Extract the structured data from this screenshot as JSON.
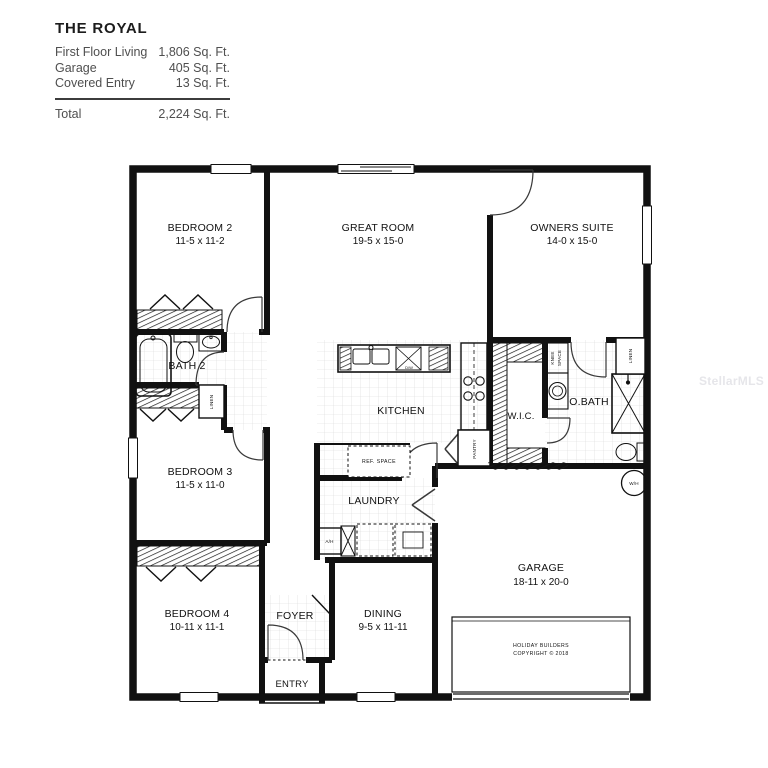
{
  "title_block": {
    "name": "THE ROYAL",
    "rows": [
      {
        "label": "First Floor Living",
        "value": "1,806 Sq. Ft."
      },
      {
        "label": "Garage",
        "value": "405 Sq. Ft."
      },
      {
        "label": "Covered Entry",
        "value": "13 Sq. Ft."
      }
    ],
    "total_label": "Total",
    "total_value": "2,224 Sq. Ft."
  },
  "watermark": "StellarMLS",
  "rooms": {
    "bedroom2": {
      "name": "BEDROOM 2",
      "dims": "11-5 x 11-2"
    },
    "great_room": {
      "name": "GREAT ROOM",
      "dims": "19-5 x 15-0"
    },
    "owners_suite": {
      "name": "OWNERS SUITE",
      "dims": "14-0 x 15-0"
    },
    "bath2": {
      "name": "BATH 2"
    },
    "bedroom3": {
      "name": "BEDROOM 3",
      "dims": "11-5 x 11-0"
    },
    "kitchen": {
      "name": "KITCHEN"
    },
    "laundry": {
      "name": "LAUNDRY"
    },
    "wic": {
      "name": "W.I.C."
    },
    "obath": {
      "name": "O.BATH"
    },
    "garage": {
      "name": "GARAGE",
      "dims": "18-11 x 20-0"
    },
    "bedroom4": {
      "name": "BEDROOM 4",
      "dims": "10-11 x 11-1"
    },
    "foyer": {
      "name": "FOYER"
    },
    "dining": {
      "name": "DINING",
      "dims": "9-5 x 11-11"
    },
    "entry": {
      "name": "ENTRY"
    }
  },
  "annotations": {
    "linen_left": "LINEN",
    "linen_right": "LINEN",
    "pantry": "PANTRY",
    "knee_line1": "KNEE",
    "knee_line2": "SPACE",
    "ref_space": "REF.  SPACE",
    "ah": "A/H",
    "wh": "W/H",
    "dw": "D/W",
    "copyright1": "HOLIDAY  BUILDERS",
    "copyright2": "COPYRIGHT © 2018"
  }
}
